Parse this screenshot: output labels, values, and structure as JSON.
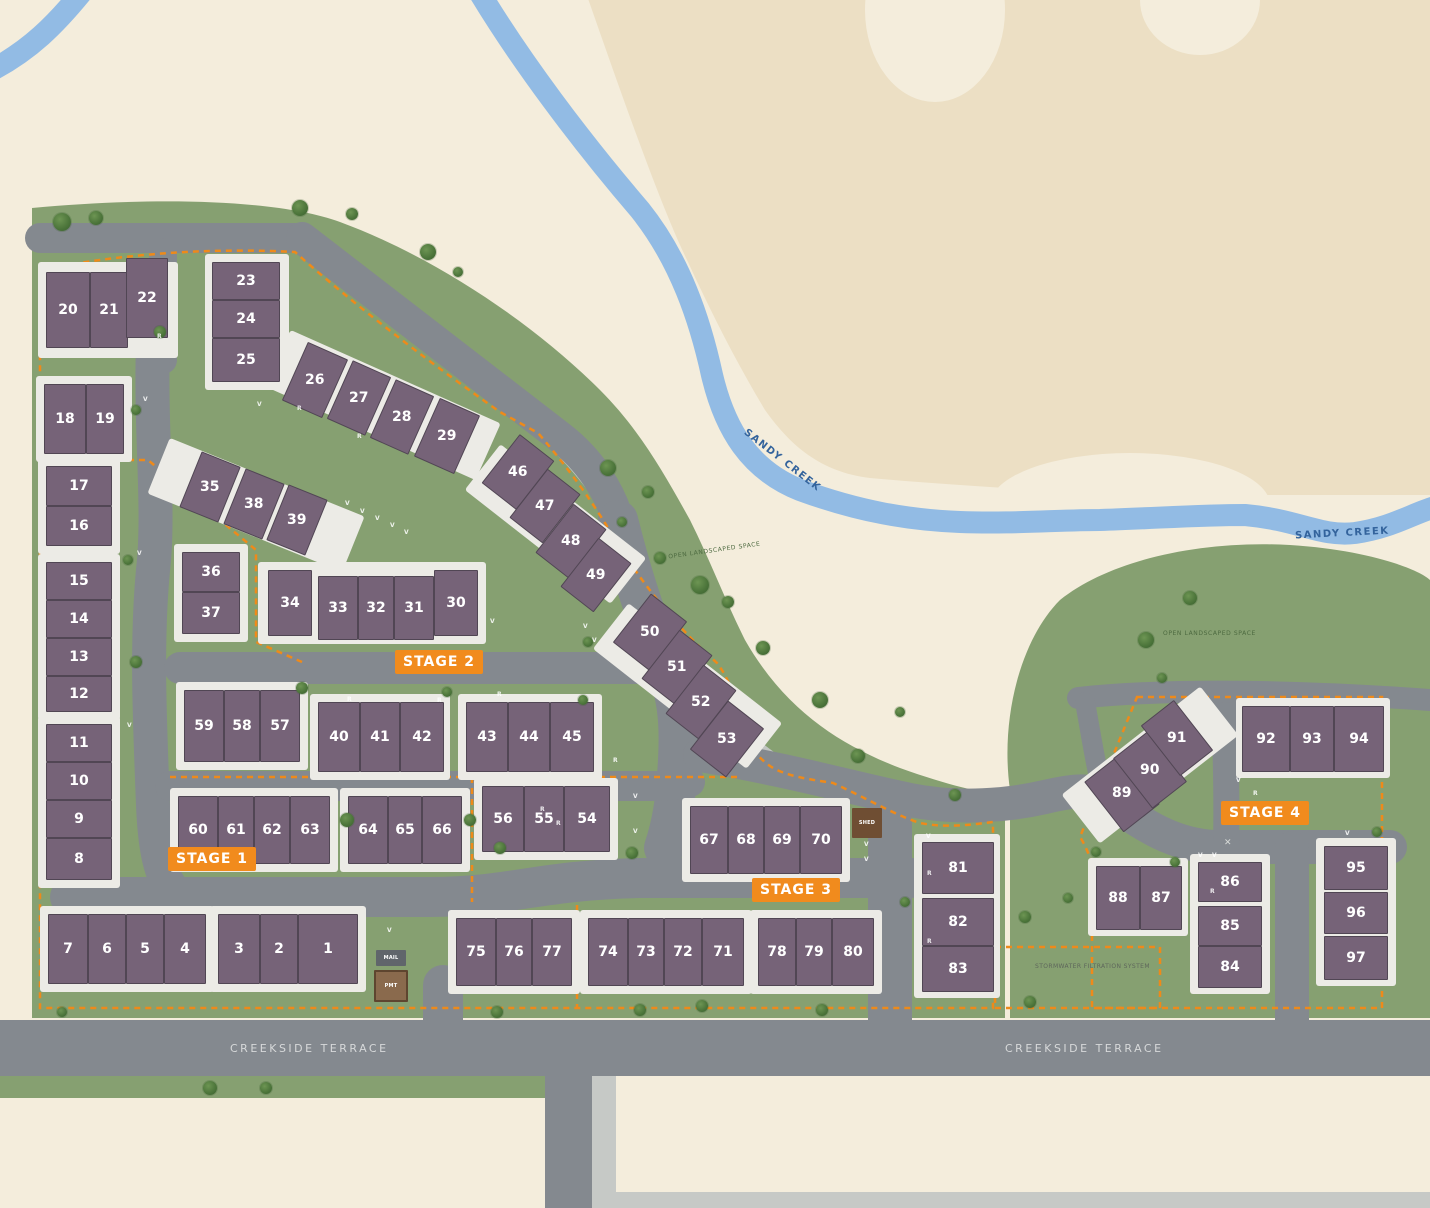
{
  "map": {
    "creek_name": "SANDY CREEK",
    "street_name": "CREEKSIDE TERRACE",
    "colors": {
      "cream": "#f4eddc",
      "tan": "#ecdfc4",
      "green": "#86a071",
      "road": "#84898f",
      "path": "#c1c5c1",
      "creek": "#92bbe4",
      "building": "#766378",
      "pad": "#ecebe6",
      "stage_orange": "#f18b1d",
      "boundary_orange": "#ee8a1a",
      "creek_text": "#33639c"
    }
  },
  "stages": [
    {
      "label": "STAGE 1",
      "x": 168,
      "y": 847
    },
    {
      "label": "STAGE 2",
      "x": 395,
      "y": 650
    },
    {
      "label": "STAGE 3",
      "x": 752,
      "y": 878
    },
    {
      "label": "STAGE 4",
      "x": 1221,
      "y": 801
    }
  ],
  "labels": [
    {
      "kind": "creek",
      "text": "SANDY CREEK",
      "x": 735,
      "y": 455,
      "rot": 38
    },
    {
      "kind": "creek",
      "text": "SANDY CREEK",
      "x": 1295,
      "y": 528,
      "rot": -3
    },
    {
      "kind": "street",
      "text": "CREEKSIDE TERRACE",
      "x": 230,
      "y": 1042,
      "rot": 0
    },
    {
      "kind": "street",
      "text": "CREEKSIDE TERRACE",
      "x": 1005,
      "y": 1042,
      "rot": 0
    },
    {
      "kind": "area",
      "text": "OPEN LANDSCAPED SPACE",
      "x": 668,
      "y": 547,
      "rot": -8
    },
    {
      "kind": "area",
      "text": "OPEN LANDSCAPED SPACE",
      "x": 1163,
      "y": 630,
      "rot": 0
    },
    {
      "kind": "storm",
      "text": "STORMWATER FILTRATION SYSTEM",
      "x": 1035,
      "y": 963,
      "rot": 0
    }
  ],
  "structures": [
    {
      "label": "SHED",
      "type": "shed",
      "x": 852,
      "y": 808,
      "w": 30,
      "h": 30
    },
    {
      "label": "MAIL",
      "type": "mail",
      "x": 376,
      "y": 950,
      "w": 30,
      "h": 16
    },
    {
      "label": "PMT",
      "type": "pmt",
      "x": 374,
      "y": 970,
      "w": 34,
      "h": 32
    }
  ],
  "pads": [
    {
      "x": 38,
      "y": 262,
      "w": 140,
      "h": 96
    },
    {
      "x": 205,
      "y": 254,
      "w": 84,
      "h": 136
    },
    {
      "x": 36,
      "y": 376,
      "w": 96,
      "h": 86
    },
    {
      "x": 38,
      "y": 458,
      "w": 82,
      "h": 96
    },
    {
      "x": 38,
      "y": 554,
      "w": 82,
      "h": 166
    },
    {
      "x": 38,
      "y": 716,
      "w": 82,
      "h": 172
    },
    {
      "x": 40,
      "y": 906,
      "w": 174,
      "h": 86
    },
    {
      "x": 210,
      "y": 906,
      "w": 156,
      "h": 86
    },
    {
      "x": 176,
      "y": 682,
      "w": 132,
      "h": 88
    },
    {
      "x": 170,
      "y": 788,
      "w": 168,
      "h": 84
    },
    {
      "x": 340,
      "y": 788,
      "w": 130,
      "h": 84
    },
    {
      "x": 174,
      "y": 544,
      "w": 74,
      "h": 98
    },
    {
      "x": 151,
      "y": 475,
      "w": 210,
      "h": 60,
      "r": 22
    },
    {
      "x": 268,
      "y": 374,
      "w": 230,
      "h": 62,
      "r": 24
    },
    {
      "x": 258,
      "y": 562,
      "w": 228,
      "h": 82
    },
    {
      "x": 310,
      "y": 694,
      "w": 140,
      "h": 86
    },
    {
      "x": 458,
      "y": 694,
      "w": 144,
      "h": 86
    },
    {
      "x": 474,
      "y": 778,
      "w": 144,
      "h": 82
    },
    {
      "x": 463,
      "y": 495,
      "w": 185,
      "h": 58,
      "r": 38
    },
    {
      "x": 590,
      "y": 657,
      "w": 195,
      "h": 58,
      "r": 38
    },
    {
      "x": 682,
      "y": 798,
      "w": 168,
      "h": 84
    },
    {
      "x": 448,
      "y": 910,
      "w": 132,
      "h": 84
    },
    {
      "x": 580,
      "y": 910,
      "w": 172,
      "h": 84
    },
    {
      "x": 750,
      "y": 910,
      "w": 132,
      "h": 84
    },
    {
      "x": 914,
      "y": 834,
      "w": 86,
      "h": 164
    },
    {
      "x": 1062,
      "y": 734,
      "w": 176,
      "h": 62,
      "r": -38
    },
    {
      "x": 1236,
      "y": 698,
      "w": 154,
      "h": 80
    },
    {
      "x": 1088,
      "y": 858,
      "w": 100,
      "h": 78
    },
    {
      "x": 1190,
      "y": 854,
      "w": 80,
      "h": 140
    },
    {
      "x": 1316,
      "y": 838,
      "w": 80,
      "h": 148
    }
  ],
  "lots": [
    {
      "n": 20,
      "x": 46,
      "y": 272,
      "w": 44,
      "h": 76
    },
    {
      "n": 21,
      "x": 90,
      "y": 272,
      "w": 38,
      "h": 76
    },
    {
      "n": 22,
      "x": 126,
      "y": 258,
      "w": 42,
      "h": 80
    },
    {
      "n": 23,
      "x": 212,
      "y": 262,
      "w": 68,
      "h": 38
    },
    {
      "n": 24,
      "x": 212,
      "y": 300,
      "w": 68,
      "h": 38
    },
    {
      "n": 25,
      "x": 212,
      "y": 338,
      "w": 68,
      "h": 44
    },
    {
      "n": 18,
      "x": 44,
      "y": 384,
      "w": 42,
      "h": 70
    },
    {
      "n": 19,
      "x": 86,
      "y": 384,
      "w": 38,
      "h": 70
    },
    {
      "n": 17,
      "x": 46,
      "y": 466,
      "w": 66,
      "h": 40
    },
    {
      "n": 16,
      "x": 46,
      "y": 506,
      "w": 66,
      "h": 40
    },
    {
      "n": 15,
      "x": 46,
      "y": 562,
      "w": 66,
      "h": 38
    },
    {
      "n": 14,
      "x": 46,
      "y": 600,
      "w": 66,
      "h": 38
    },
    {
      "n": 13,
      "x": 46,
      "y": 638,
      "w": 66,
      "h": 38
    },
    {
      "n": 12,
      "x": 46,
      "y": 676,
      "w": 66,
      "h": 36
    },
    {
      "n": 11,
      "x": 46,
      "y": 724,
      "w": 66,
      "h": 38
    },
    {
      "n": 10,
      "x": 46,
      "y": 762,
      "w": 66,
      "h": 38
    },
    {
      "n": 9,
      "x": 46,
      "y": 800,
      "w": 66,
      "h": 38
    },
    {
      "n": 8,
      "x": 46,
      "y": 838,
      "w": 66,
      "h": 42
    },
    {
      "n": 7,
      "x": 48,
      "y": 914,
      "w": 40,
      "h": 70
    },
    {
      "n": 6,
      "x": 88,
      "y": 914,
      "w": 38,
      "h": 70
    },
    {
      "n": 5,
      "x": 126,
      "y": 914,
      "w": 38,
      "h": 70
    },
    {
      "n": 4,
      "x": 164,
      "y": 914,
      "w": 42,
      "h": 70
    },
    {
      "n": 3,
      "x": 218,
      "y": 914,
      "w": 42,
      "h": 70
    },
    {
      "n": 2,
      "x": 260,
      "y": 914,
      "w": 38,
      "h": 70
    },
    {
      "n": 1,
      "x": 298,
      "y": 914,
      "w": 60,
      "h": 70
    },
    {
      "n": 59,
      "x": 184,
      "y": 690,
      "w": 40,
      "h": 72
    },
    {
      "n": 58,
      "x": 224,
      "y": 690,
      "w": 36,
      "h": 72
    },
    {
      "n": 57,
      "x": 260,
      "y": 690,
      "w": 40,
      "h": 72
    },
    {
      "n": 60,
      "x": 178,
      "y": 796,
      "w": 40,
      "h": 68
    },
    {
      "n": 61,
      "x": 218,
      "y": 796,
      "w": 36,
      "h": 68
    },
    {
      "n": 62,
      "x": 254,
      "y": 796,
      "w": 36,
      "h": 68
    },
    {
      "n": 63,
      "x": 290,
      "y": 796,
      "w": 40,
      "h": 68
    },
    {
      "n": 64,
      "x": 348,
      "y": 796,
      "w": 40,
      "h": 68
    },
    {
      "n": 65,
      "x": 388,
      "y": 796,
      "w": 34,
      "h": 68
    },
    {
      "n": 66,
      "x": 422,
      "y": 796,
      "w": 40,
      "h": 68
    },
    {
      "n": 35,
      "x": 189,
      "y": 457,
      "w": 42,
      "h": 60,
      "r": 22
    },
    {
      "n": 38,
      "x": 233,
      "y": 474,
      "w": 42,
      "h": 60,
      "r": 22
    },
    {
      "n": 39,
      "x": 276,
      "y": 490,
      "w": 42,
      "h": 60,
      "r": 22
    },
    {
      "n": 36,
      "x": 182,
      "y": 552,
      "w": 58,
      "h": 40
    },
    {
      "n": 37,
      "x": 182,
      "y": 592,
      "w": 58,
      "h": 42
    },
    {
      "n": 34,
      "x": 268,
      "y": 570,
      "w": 44,
      "h": 66
    },
    {
      "n": 33,
      "x": 318,
      "y": 576,
      "w": 40,
      "h": 64
    },
    {
      "n": 32,
      "x": 358,
      "y": 576,
      "w": 36,
      "h": 64
    },
    {
      "n": 31,
      "x": 394,
      "y": 576,
      "w": 40,
      "h": 64
    },
    {
      "n": 30,
      "x": 434,
      "y": 570,
      "w": 44,
      "h": 66
    },
    {
      "n": 26,
      "x": 293,
      "y": 348,
      "w": 44,
      "h": 64,
      "r": 24
    },
    {
      "n": 27,
      "x": 338,
      "y": 366,
      "w": 42,
      "h": 64,
      "r": 24
    },
    {
      "n": 28,
      "x": 381,
      "y": 385,
      "w": 42,
      "h": 64,
      "r": 24
    },
    {
      "n": 29,
      "x": 425,
      "y": 404,
      "w": 44,
      "h": 64,
      "r": 24
    },
    {
      "n": 40,
      "x": 318,
      "y": 702,
      "w": 42,
      "h": 70
    },
    {
      "n": 41,
      "x": 360,
      "y": 702,
      "w": 40,
      "h": 70
    },
    {
      "n": 42,
      "x": 400,
      "y": 702,
      "w": 44,
      "h": 70
    },
    {
      "n": 43,
      "x": 466,
      "y": 702,
      "w": 42,
      "h": 70
    },
    {
      "n": 44,
      "x": 508,
      "y": 702,
      "w": 42,
      "h": 70
    },
    {
      "n": 45,
      "x": 550,
      "y": 702,
      "w": 44,
      "h": 70
    },
    {
      "n": 46,
      "x": 496,
      "y": 441,
      "w": 44,
      "h": 62,
      "r": 38
    },
    {
      "n": 47,
      "x": 524,
      "y": 475,
      "w": 42,
      "h": 62,
      "r": 38
    },
    {
      "n": 48,
      "x": 550,
      "y": 510,
      "w": 42,
      "h": 62,
      "r": 38
    },
    {
      "n": 49,
      "x": 575,
      "y": 544,
      "w": 42,
      "h": 62,
      "r": 38
    },
    {
      "n": 50,
      "x": 627,
      "y": 601,
      "w": 46,
      "h": 62,
      "r": 38
    },
    {
      "n": 51,
      "x": 656,
      "y": 636,
      "w": 42,
      "h": 62,
      "r": 38
    },
    {
      "n": 52,
      "x": 680,
      "y": 671,
      "w": 42,
      "h": 62,
      "r": 38
    },
    {
      "n": 53,
      "x": 704,
      "y": 708,
      "w": 46,
      "h": 62,
      "r": 38
    },
    {
      "n": 56,
      "x": 482,
      "y": 786,
      "w": 42,
      "h": 66
    },
    {
      "n": 55,
      "x": 524,
      "y": 786,
      "w": 40,
      "h": 66
    },
    {
      "n": 54,
      "x": 564,
      "y": 786,
      "w": 46,
      "h": 66
    },
    {
      "n": 67,
      "x": 690,
      "y": 806,
      "w": 38,
      "h": 68
    },
    {
      "n": 68,
      "x": 728,
      "y": 806,
      "w": 36,
      "h": 68
    },
    {
      "n": 69,
      "x": 764,
      "y": 806,
      "w": 36,
      "h": 68
    },
    {
      "n": 70,
      "x": 800,
      "y": 806,
      "w": 42,
      "h": 68
    },
    {
      "n": 75,
      "x": 456,
      "y": 918,
      "w": 40,
      "h": 68
    },
    {
      "n": 76,
      "x": 496,
      "y": 918,
      "w": 36,
      "h": 68
    },
    {
      "n": 77,
      "x": 532,
      "y": 918,
      "w": 40,
      "h": 68
    },
    {
      "n": 74,
      "x": 588,
      "y": 918,
      "w": 40,
      "h": 68
    },
    {
      "n": 73,
      "x": 628,
      "y": 918,
      "w": 36,
      "h": 68
    },
    {
      "n": 72,
      "x": 664,
      "y": 918,
      "w": 38,
      "h": 68
    },
    {
      "n": 71,
      "x": 702,
      "y": 918,
      "w": 42,
      "h": 68
    },
    {
      "n": 78,
      "x": 758,
      "y": 918,
      "w": 38,
      "h": 68
    },
    {
      "n": 79,
      "x": 796,
      "y": 918,
      "w": 36,
      "h": 68
    },
    {
      "n": 80,
      "x": 832,
      "y": 918,
      "w": 42,
      "h": 68
    },
    {
      "n": 81,
      "x": 922,
      "y": 842,
      "w": 72,
      "h": 52
    },
    {
      "n": 82,
      "x": 922,
      "y": 898,
      "w": 72,
      "h": 48
    },
    {
      "n": 83,
      "x": 922,
      "y": 946,
      "w": 72,
      "h": 46
    },
    {
      "n": 89,
      "x": 1099,
      "y": 761,
      "w": 46,
      "h": 64,
      "r": -38
    },
    {
      "n": 90,
      "x": 1128,
      "y": 738,
      "w": 44,
      "h": 64,
      "r": -38
    },
    {
      "n": 91,
      "x": 1156,
      "y": 706,
      "w": 42,
      "h": 64,
      "r": -38
    },
    {
      "n": 92,
      "x": 1242,
      "y": 706,
      "w": 48,
      "h": 66
    },
    {
      "n": 93,
      "x": 1290,
      "y": 706,
      "w": 44,
      "h": 66
    },
    {
      "n": 94,
      "x": 1334,
      "y": 706,
      "w": 50,
      "h": 66
    },
    {
      "n": 88,
      "x": 1096,
      "y": 866,
      "w": 44,
      "h": 64
    },
    {
      "n": 87,
      "x": 1140,
      "y": 866,
      "w": 42,
      "h": 64
    },
    {
      "n": 86,
      "x": 1198,
      "y": 862,
      "w": 64,
      "h": 40
    },
    {
      "n": 85,
      "x": 1198,
      "y": 906,
      "w": 64,
      "h": 40
    },
    {
      "n": 84,
      "x": 1198,
      "y": 946,
      "w": 64,
      "h": 42
    },
    {
      "n": 95,
      "x": 1324,
      "y": 846,
      "w": 64,
      "h": 44
    },
    {
      "n": 96,
      "x": 1324,
      "y": 892,
      "w": 64,
      "h": 42
    },
    {
      "n": 97,
      "x": 1324,
      "y": 936,
      "w": 64,
      "h": 44
    }
  ],
  "markers": [
    {
      "t": "V",
      "x": 143,
      "y": 396
    },
    {
      "t": "V",
      "x": 257,
      "y": 401
    },
    {
      "t": "V",
      "x": 137,
      "y": 550
    },
    {
      "t": "V",
      "x": 127,
      "y": 722
    },
    {
      "t": "V",
      "x": 387,
      "y": 927
    },
    {
      "t": "V",
      "x": 345,
      "y": 500
    },
    {
      "t": "V",
      "x": 360,
      "y": 508
    },
    {
      "t": "V",
      "x": 375,
      "y": 515
    },
    {
      "t": "V",
      "x": 390,
      "y": 522
    },
    {
      "t": "V",
      "x": 404,
      "y": 529
    },
    {
      "t": "V",
      "x": 490,
      "y": 618
    },
    {
      "t": "V",
      "x": 583,
      "y": 623
    },
    {
      "t": "V",
      "x": 592,
      "y": 637
    },
    {
      "t": "V",
      "x": 633,
      "y": 793
    },
    {
      "t": "V",
      "x": 633,
      "y": 828
    },
    {
      "t": "V",
      "x": 864,
      "y": 841
    },
    {
      "t": "V",
      "x": 864,
      "y": 856
    },
    {
      "t": "V",
      "x": 926,
      "y": 833
    },
    {
      "t": "V",
      "x": 1236,
      "y": 777
    },
    {
      "t": "V",
      "x": 1198,
      "y": 852
    },
    {
      "t": "V",
      "x": 1212,
      "y": 852
    },
    {
      "t": "V",
      "x": 1345,
      "y": 830
    },
    {
      "t": "R",
      "x": 157,
      "y": 333
    },
    {
      "t": "R",
      "x": 297,
      "y": 405
    },
    {
      "t": "R",
      "x": 357,
      "y": 433
    },
    {
      "t": "R",
      "x": 347,
      "y": 696
    },
    {
      "t": "R",
      "x": 437,
      "y": 697
    },
    {
      "t": "R",
      "x": 497,
      "y": 691
    },
    {
      "t": "R",
      "x": 613,
      "y": 757
    },
    {
      "t": "R",
      "x": 927,
      "y": 870
    },
    {
      "t": "R",
      "x": 927,
      "y": 938
    },
    {
      "t": "R",
      "x": 1253,
      "y": 790
    },
    {
      "t": "R",
      "x": 1210,
      "y": 888
    },
    {
      "t": "R",
      "x": 540,
      "y": 806
    },
    {
      "t": "R",
      "x": 556,
      "y": 820
    }
  ],
  "trees": [
    {
      "x": 62,
      "y": 222,
      "s": 18
    },
    {
      "x": 96,
      "y": 218,
      "s": 14
    },
    {
      "x": 300,
      "y": 208,
      "s": 16
    },
    {
      "x": 352,
      "y": 214,
      "s": 12
    },
    {
      "x": 428,
      "y": 252,
      "s": 16
    },
    {
      "x": 458,
      "y": 272,
      "s": 10
    },
    {
      "x": 608,
      "y": 468,
      "s": 16
    },
    {
      "x": 648,
      "y": 492,
      "s": 12
    },
    {
      "x": 700,
      "y": 585,
      "s": 18
    },
    {
      "x": 728,
      "y": 602,
      "s": 12
    },
    {
      "x": 763,
      "y": 648,
      "s": 14
    },
    {
      "x": 820,
      "y": 700,
      "s": 16
    },
    {
      "x": 858,
      "y": 756,
      "s": 14
    },
    {
      "x": 900,
      "y": 712,
      "s": 10
    },
    {
      "x": 660,
      "y": 558,
      "s": 12
    },
    {
      "x": 622,
      "y": 522,
      "s": 10
    },
    {
      "x": 588,
      "y": 642,
      "s": 10
    },
    {
      "x": 955,
      "y": 795,
      "s": 12
    },
    {
      "x": 1146,
      "y": 640,
      "s": 16
    },
    {
      "x": 1190,
      "y": 598,
      "s": 14
    },
    {
      "x": 1162,
      "y": 678,
      "s": 10
    },
    {
      "x": 160,
      "y": 332,
      "s": 12
    },
    {
      "x": 136,
      "y": 410,
      "s": 10
    },
    {
      "x": 128,
      "y": 560,
      "s": 10
    },
    {
      "x": 136,
      "y": 662,
      "s": 12
    },
    {
      "x": 302,
      "y": 688,
      "s": 12
    },
    {
      "x": 347,
      "y": 820,
      "s": 14
    },
    {
      "x": 470,
      "y": 820,
      "s": 12
    },
    {
      "x": 447,
      "y": 692,
      "s": 10
    },
    {
      "x": 583,
      "y": 700,
      "s": 10
    },
    {
      "x": 500,
      "y": 848,
      "s": 12
    },
    {
      "x": 632,
      "y": 853,
      "s": 12
    },
    {
      "x": 62,
      "y": 1012,
      "s": 10
    },
    {
      "x": 210,
      "y": 1088,
      "s": 14
    },
    {
      "x": 266,
      "y": 1088,
      "s": 12
    },
    {
      "x": 497,
      "y": 1012,
      "s": 12
    },
    {
      "x": 640,
      "y": 1010,
      "s": 12
    },
    {
      "x": 702,
      "y": 1006,
      "s": 12
    },
    {
      "x": 822,
      "y": 1010,
      "s": 12
    },
    {
      "x": 1030,
      "y": 1002,
      "s": 12
    },
    {
      "x": 1025,
      "y": 917,
      "s": 12
    },
    {
      "x": 1068,
      "y": 898,
      "s": 10
    },
    {
      "x": 905,
      "y": 902,
      "s": 10
    },
    {
      "x": 1377,
      "y": 832,
      "s": 10
    },
    {
      "x": 1175,
      "y": 862,
      "s": 10
    },
    {
      "x": 1096,
      "y": 852,
      "s": 10
    }
  ],
  "icons": [
    {
      "name": "playground-icon",
      "glyph": "✕",
      "x": 1224,
      "y": 838
    }
  ]
}
